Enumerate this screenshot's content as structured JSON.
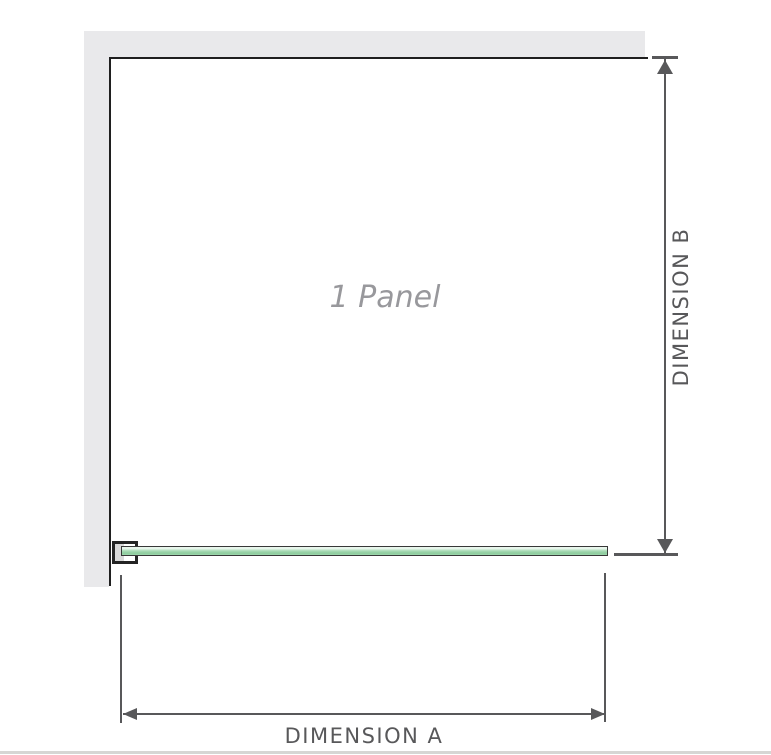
{
  "diagram": {
    "title": "shower-screen-panel-dimension-diagram",
    "panel_label": "1 Panel",
    "dimension_a_label": "DIMENSION A",
    "dimension_b_label": "DIMENSION B"
  },
  "colors": {
    "wall": "#e9e9eb",
    "panel_border": "#1f1f1f",
    "dimension": "#58585a",
    "glass_green": "#9fd6ad",
    "glass_green_light": "#e8f6ec",
    "glass_border": "#383838",
    "panel_label_gray": "#98989c",
    "baseline": "#d6d6d4"
  }
}
